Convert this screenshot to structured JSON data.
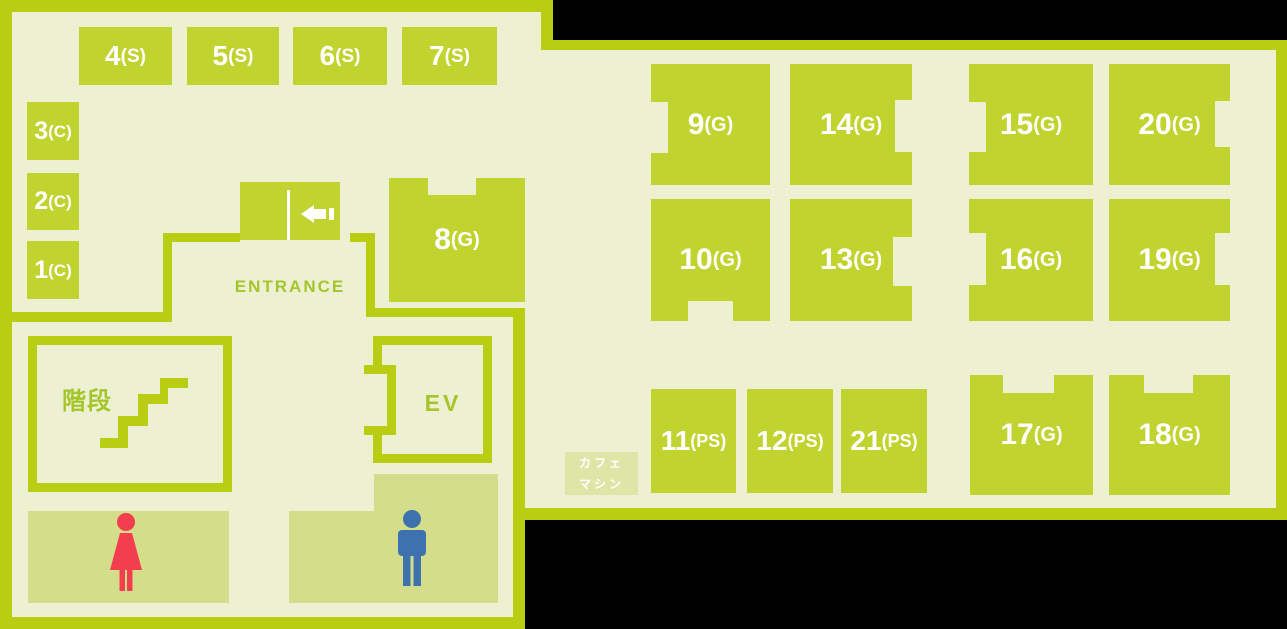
{
  "colors": {
    "background": "#000000",
    "floor": "#eef0d2",
    "wall": "#b9ce12",
    "room": "#c1d32f",
    "restroom": "#d4dd8a",
    "cafe": "#dfe5a7",
    "room_label_text": "#ffffff",
    "maptext": "#a4c62c",
    "woman": "#f23e4e",
    "man": "#3d72ae"
  },
  "rooms": [
    {
      "number": "1",
      "suffix": "(C)"
    },
    {
      "number": "2",
      "suffix": "(C)"
    },
    {
      "number": "3",
      "suffix": "(C)"
    },
    {
      "number": "4",
      "suffix": "(S)"
    },
    {
      "number": "5",
      "suffix": "(S)"
    },
    {
      "number": "6",
      "suffix": "(S)"
    },
    {
      "number": "7",
      "suffix": "(S)"
    },
    {
      "number": "8",
      "suffix": "(G)"
    },
    {
      "number": "9",
      "suffix": "(G)"
    },
    {
      "number": "10",
      "suffix": "(G)"
    },
    {
      "number": "11",
      "suffix": "(PS)"
    },
    {
      "number": "12",
      "suffix": "(PS)"
    },
    {
      "number": "13",
      "suffix": "(G)"
    },
    {
      "number": "14",
      "suffix": "(G)"
    },
    {
      "number": "15",
      "suffix": "(G)"
    },
    {
      "number": "16",
      "suffix": "(G)"
    },
    {
      "number": "17",
      "suffix": "(G)"
    },
    {
      "number": "18",
      "suffix": "(G)"
    },
    {
      "number": "19",
      "suffix": "(G)"
    },
    {
      "number": "20",
      "suffix": "(G)"
    },
    {
      "number": "21",
      "suffix": "(PS)"
    }
  ],
  "labels": {
    "entrance": "ENTRANCE",
    "stairs": "階段",
    "elevator": "EV",
    "cafe_machine_line1": "カフェ",
    "cafe_machine_line2": "マシン"
  }
}
